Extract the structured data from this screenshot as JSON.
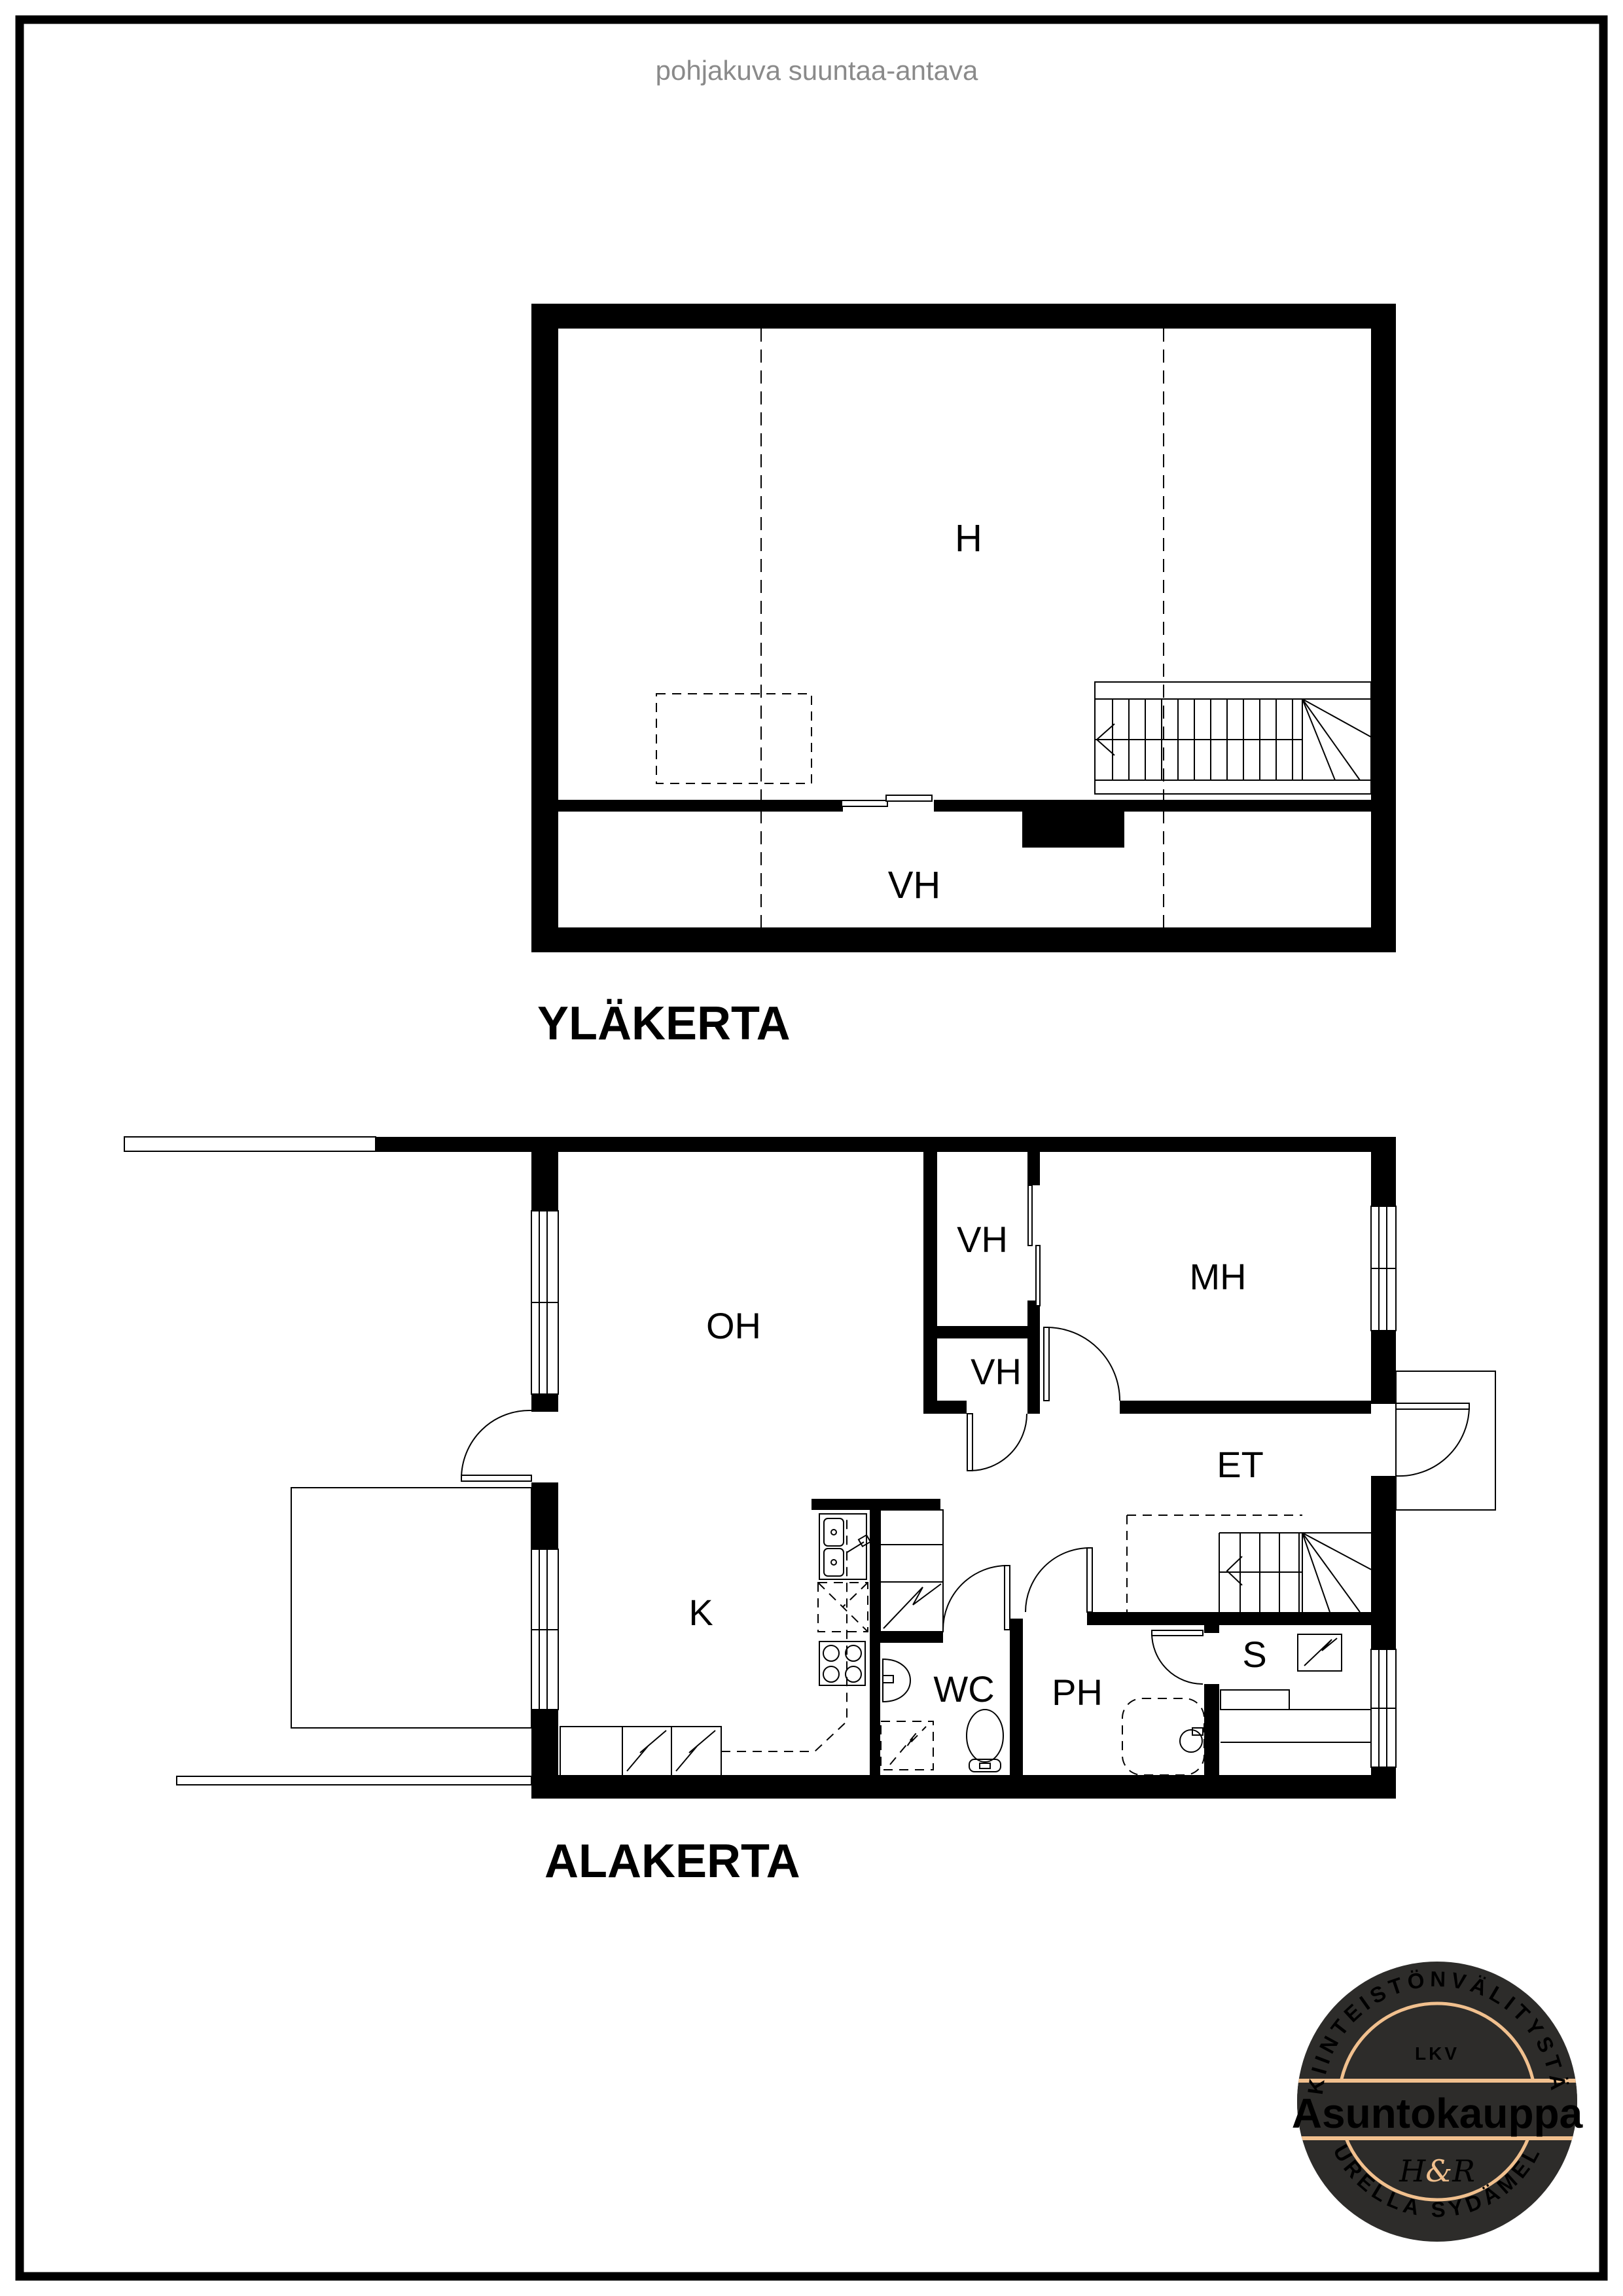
{
  "page": {
    "title": "pohjakuva suuntaa-antava"
  },
  "colors": {
    "wall": "#000000",
    "background": "#ffffff",
    "title_gray": "#8a8a8a",
    "logo_bg": "#2d2c2a",
    "logo_accent": "#f1c08e",
    "logo_text": "#ffffff"
  },
  "upper_floor": {
    "title": "YLÄKERTA",
    "room_h": "H",
    "room_vh": "VH"
  },
  "lower_floor": {
    "title": "ALAKERTA",
    "room_oh": "OH",
    "room_k": "K",
    "room_vh1": "VH",
    "room_vh2": "VH",
    "room_mh": "MH",
    "room_et": "ET",
    "room_wc": "WC",
    "room_ph": "PH",
    "room_s": "S"
  },
  "logo": {
    "arc_top": "KIINTEISTÖNVÄLITYSTÄ",
    "lkv": "LKV",
    "brand": "Asuntokauppa",
    "monogram_h": "H",
    "monogram_amp": "&",
    "monogram_r": "R",
    "arc_bottom": "SUURELLA SYDÄMELLÄ"
  }
}
